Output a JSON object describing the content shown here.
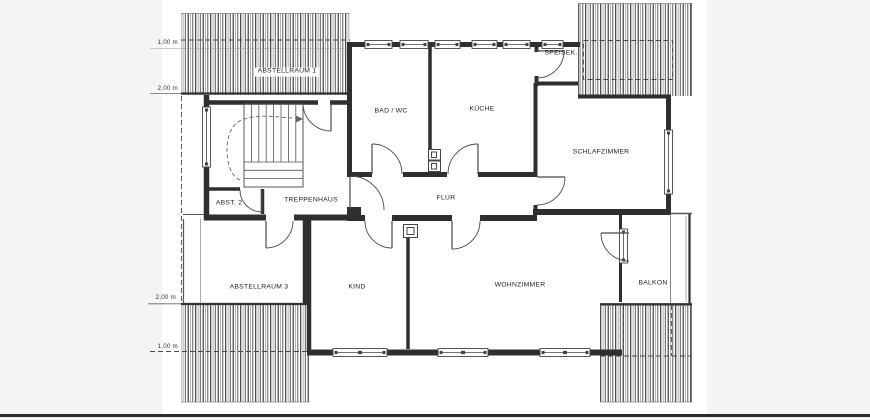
{
  "drawing": {
    "kind": "floor-plan",
    "rooms": [
      {
        "label": "ABSTELLRAUM 1"
      },
      {
        "label": "BAD / WC"
      },
      {
        "label": "KÜCHE"
      },
      {
        "label": "SPEISEK."
      },
      {
        "label": "SCHLAFZIMMER"
      },
      {
        "label": "ABST. 2"
      },
      {
        "label": "TREPPENHAUS"
      },
      {
        "label": "FLUR"
      },
      {
        "label": "ABSTELLRAUM 3"
      },
      {
        "label": "KIND"
      },
      {
        "label": "WOHNZIMMER"
      },
      {
        "label": "BALKON"
      }
    ],
    "dimension_labels": [
      {
        "label": "1,00 m"
      },
      {
        "label": "2,00 m"
      },
      {
        "label": "2,00 m"
      },
      {
        "label": "1,00 m"
      }
    ],
    "colors": {
      "margin_bg": "#f4f4f5",
      "paper_bg": "#ffffff",
      "wall_line": "#2f2f2f",
      "thin_line": "#6b6b6b",
      "bottom_bar": "#2b2b2b",
      "text": "#222222"
    }
  }
}
